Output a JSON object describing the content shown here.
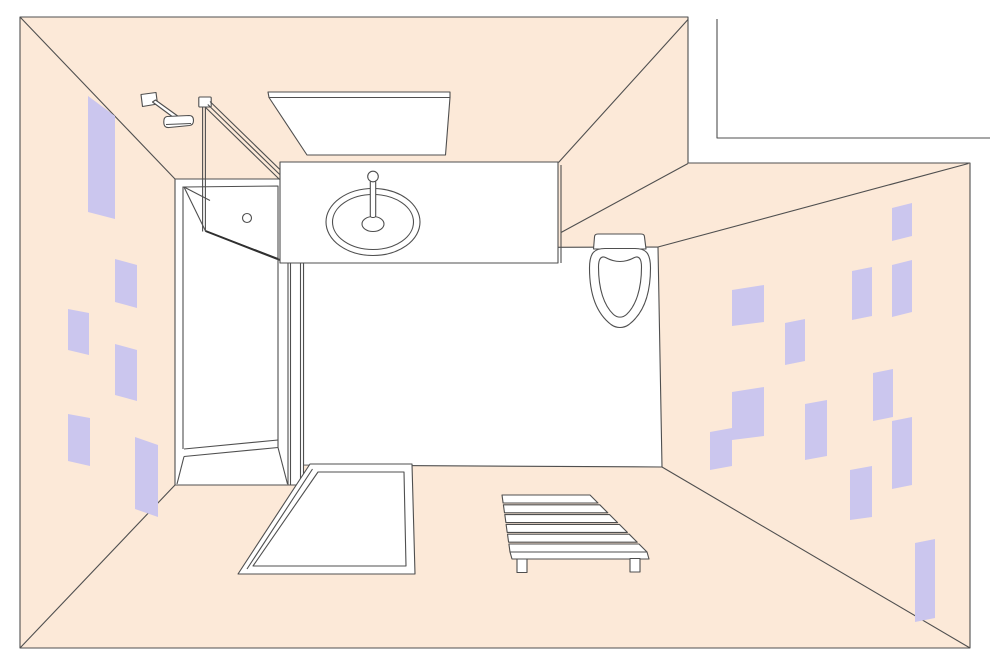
{
  "palette": {
    "wall": "#fce9d8",
    "tile": "#cbc6ee",
    "line": "#4f4f4f",
    "dark": "#2f2f2f",
    "white": "#ffffff",
    "none": "none"
  },
  "shapes": [
    {
      "name": "room-wall-band",
      "type": "polygon",
      "f": "wall",
      "s": "line",
      "attrs": {
        "points": "20,17 688,17 688,163 970,163 970,648 20,648"
      }
    },
    {
      "name": "adjacent-wall-line",
      "type": "polyline",
      "f": "none",
      "s": "line",
      "attrs": {
        "points": "717,19 717,138 990,138"
      }
    },
    {
      "name": "corner-seam-top-left",
      "type": "line",
      "f": "none",
      "s": "line",
      "attrs": {
        "x1": "20",
        "y1": "17",
        "x2": "175",
        "y2": "179"
      }
    },
    {
      "name": "corner-seam-bottom-left",
      "type": "line",
      "f": "none",
      "s": "line",
      "attrs": {
        "x1": "20",
        "y1": "648",
        "x2": "175",
        "y2": "485"
      }
    },
    {
      "name": "corner-seam-bottom-right",
      "type": "line",
      "f": "none",
      "s": "line",
      "attrs": {
        "x1": "970",
        "y1": "648",
        "x2": "662",
        "y2": "467"
      }
    },
    {
      "name": "corner-seam-top-right",
      "type": "line",
      "f": "none",
      "s": "line",
      "attrs": {
        "x1": "658",
        "y1": "247",
        "x2": "968.5",
        "y2": "163.5"
      }
    },
    {
      "name": "wall-corner-seam-upper",
      "type": "line",
      "f": "none",
      "s": "line",
      "attrs": {
        "x1": "561",
        "y1": "232.5",
        "x2": "688",
        "y2": "163.5"
      }
    },
    {
      "name": "wall-corner-seam-top",
      "type": "line",
      "f": "none",
      "s": "line",
      "attrs": {
        "x1": "558.5",
        "y1": "162.5",
        "x2": "688",
        "y2": "19.5"
      }
    },
    {
      "name": "left-wall-tile",
      "type": "polygon",
      "f": "tile",
      "s": "none",
      "attrs": {
        "points": "88,96 115,116 115,219 88,212"
      }
    },
    {
      "name": "left-wall-tile",
      "type": "polygon",
      "f": "tile",
      "s": "none",
      "attrs": {
        "points": "115,259 137,265 137,308 115,302"
      }
    },
    {
      "name": "left-wall-tile",
      "type": "polygon",
      "f": "tile",
      "s": "none",
      "attrs": {
        "points": "68,309 89,313 89,355 68,350"
      }
    },
    {
      "name": "left-wall-tile",
      "type": "polygon",
      "f": "tile",
      "s": "none",
      "attrs": {
        "points": "115,344 137,350 137,401 115,395"
      }
    },
    {
      "name": "left-wall-tile",
      "type": "polygon",
      "f": "tile",
      "s": "none",
      "attrs": {
        "points": "68,414 90,418 90,466 68,461"
      }
    },
    {
      "name": "left-wall-tile",
      "type": "polygon",
      "f": "tile",
      "s": "none",
      "attrs": {
        "points": "135,437 158,445 158,517 135,509"
      }
    },
    {
      "name": "right-wall-tile",
      "type": "polygon",
      "f": "tile",
      "s": "none",
      "attrs": {
        "points": "892,208 912,203 912,236 892,241"
      }
    },
    {
      "name": "right-wall-tile",
      "type": "polygon",
      "f": "tile",
      "s": "none",
      "attrs": {
        "points": "852,271 872,267 872,316 852,320"
      }
    },
    {
      "name": "right-wall-tile",
      "type": "polygon",
      "f": "tile",
      "s": "none",
      "attrs": {
        "points": "892,265 912,260 912,312 892,317"
      }
    },
    {
      "name": "right-wall-tile",
      "type": "polygon",
      "f": "tile",
      "s": "none",
      "attrs": {
        "points": "732,290 764,285 764,322 732,326"
      }
    },
    {
      "name": "right-wall-tile",
      "type": "polygon",
      "f": "tile",
      "s": "none",
      "attrs": {
        "points": "785,323 805,319 805,361 785,365"
      }
    },
    {
      "name": "right-wall-tile",
      "type": "polygon",
      "f": "tile",
      "s": "none",
      "attrs": {
        "points": "732,392 764,387 764,436 732,440"
      }
    },
    {
      "name": "right-wall-tile",
      "type": "polygon",
      "f": "tile",
      "s": "none",
      "attrs": {
        "points": "710,432 732,428 732,466 710,470"
      }
    },
    {
      "name": "right-wall-tile",
      "type": "polygon",
      "f": "tile",
      "s": "none",
      "attrs": {
        "points": "805,404 827,400 827,456 805,460"
      }
    },
    {
      "name": "right-wall-tile",
      "type": "polygon",
      "f": "tile",
      "s": "none",
      "attrs": {
        "points": "873,373 893,369 893,417 873,421"
      }
    },
    {
      "name": "right-wall-tile",
      "type": "polygon",
      "f": "tile",
      "s": "none",
      "attrs": {
        "points": "892,421 912,417 912,485 892,489"
      }
    },
    {
      "name": "right-wall-tile",
      "type": "polygon",
      "f": "tile",
      "s": "none",
      "attrs": {
        "points": "850,470 872,466 872,517 850,520"
      }
    },
    {
      "name": "right-wall-tile",
      "type": "polygon",
      "f": "tile",
      "s": "none",
      "attrs": {
        "points": "915,543 935,539 935,618 915,622"
      }
    },
    {
      "name": "floor",
      "type": "polygon",
      "f": "white",
      "s": "line",
      "attrs": {
        "points": "303.5,248 658,247 662,467 303.5,465"
      }
    },
    {
      "name": "ceiling-light-edge",
      "type": "polygon",
      "f": "white",
      "s": "line",
      "attrs": {
        "points": "268,92 450,92 450,97.5 269,97.5"
      }
    },
    {
      "name": "ceiling-light-panel",
      "type": "polygon",
      "f": "white",
      "s": "line",
      "attrs": {
        "points": "269,97.5 450,97.5 445.5,155 307,155"
      }
    },
    {
      "name": "towel-hook-plate",
      "type": "polygon",
      "f": "white",
      "s": "line",
      "attrs": {
        "points": "141,94.5 156,92.5 157.5,104 142.5,106.5"
      }
    },
    {
      "name": "towel-hook-arm",
      "type": "polygon",
      "f": "white",
      "s": "line",
      "attrs": {
        "points": "152.5,102 155.5,100 180.5,118 177.5,120.5"
      }
    },
    {
      "name": "towel-hook-bar",
      "type": "path",
      "f": "white",
      "s": "line",
      "attrs": {
        "d": "M167,116.5 L189,115.5 Q193.5,115.5 193.5,120.5 Q193.5,125 189.5,125.5 L169,127.5 Q164,128 163.8,122.5 Q163.6,117 167,116.5 Z"
      }
    },
    {
      "name": "towel-hook-bar-lip",
      "type": "line",
      "f": "none",
      "s": "line",
      "attrs": {
        "x1": "166",
        "y1": "124.5",
        "x2": "191",
        "y2": "123.5"
      }
    },
    {
      "name": "shower-enclosure",
      "type": "rect",
      "f": "white",
      "s": "line",
      "attrs": {
        "x": "175",
        "y": "179",
        "width": "128.5",
        "height": "306"
      }
    },
    {
      "name": "shower-inner-left-edge",
      "type": "line",
      "f": "none",
      "s": "line",
      "attrs": {
        "x1": "183",
        "y1": "186.5",
        "x2": "183",
        "y2": "449"
      }
    },
    {
      "name": "shower-door-panel",
      "type": "polygon",
      "f": "white",
      "s": "line",
      "attrs": {
        "points": "184,187 278,186 278,258.5 205.5,231"
      }
    },
    {
      "name": "shower-door-top-edge",
      "type": "line",
      "f": "none",
      "s": "line",
      "attrs": {
        "x1": "184",
        "y1": "187",
        "x2": "210",
        "y2": "200.5"
      }
    },
    {
      "name": "shower-door-front-edge",
      "type": "line",
      "f": "none",
      "s": "dark",
      "w": 2,
      "attrs": {
        "x1": "205.5",
        "y1": "231",
        "x2": "280",
        "y2": "260"
      }
    },
    {
      "name": "shower-door-handle",
      "type": "circle",
      "f": "white",
      "s": "line",
      "attrs": {
        "cx": "247",
        "cy": "218",
        "r": "4.5"
      }
    },
    {
      "name": "shower-tray-right-edge",
      "type": "line",
      "f": "none",
      "s": "line",
      "attrs": {
        "x1": "278",
        "y1": "258.5",
        "x2": "278",
        "y2": "447.5"
      }
    },
    {
      "name": "shower-tray-bottom-edge",
      "type": "line",
      "f": "none",
      "s": "line",
      "attrs": {
        "x1": "184",
        "y1": "449",
        "x2": "278",
        "y2": "440"
      }
    },
    {
      "name": "shower-tray-bottom-rim",
      "type": "line",
      "f": "none",
      "s": "line",
      "attrs": {
        "x1": "184",
        "y1": "456.5",
        "x2": "278",
        "y2": "447.5"
      }
    },
    {
      "name": "shower-tray-corner-left",
      "type": "line",
      "f": "none",
      "s": "line",
      "attrs": {
        "x1": "184",
        "y1": "456.5",
        "x2": "177",
        "y2": "484"
      }
    },
    {
      "name": "shower-tray-corner-right",
      "type": "line",
      "f": "none",
      "s": "line",
      "attrs": {
        "x1": "278",
        "y1": "447.5",
        "x2": "287.5",
        "y2": "484"
      }
    },
    {
      "name": "shower-frame-rail-a",
      "type": "line",
      "f": "none",
      "s": "line",
      "attrs": {
        "x1": "288",
        "y1": "263",
        "x2": "288",
        "y2": "484.5"
      }
    },
    {
      "name": "shower-frame-rail-b",
      "type": "line",
      "f": "none",
      "s": "line",
      "attrs": {
        "x1": "290.5",
        "y1": "263",
        "x2": "290.5",
        "y2": "484.5"
      }
    },
    {
      "name": "shower-frame-rail-c",
      "type": "line",
      "f": "none",
      "s": "line",
      "attrs": {
        "x1": "300.5",
        "y1": "263",
        "x2": "300.5",
        "y2": "484.5"
      }
    },
    {
      "name": "shower-pole-cap",
      "type": "rect",
      "f": "white",
      "s": "line",
      "attrs": {
        "x": "198.8",
        "y": "97",
        "width": "12.4",
        "height": "10",
        "rx": "1"
      }
    },
    {
      "name": "shower-pole-left",
      "type": "line",
      "f": "none",
      "s": "line",
      "attrs": {
        "x1": "202.6",
        "y1": "107",
        "x2": "202.6",
        "y2": "231.5"
      }
    },
    {
      "name": "shower-pole-right",
      "type": "line",
      "f": "none",
      "s": "line",
      "attrs": {
        "x1": "205.4",
        "y1": "107",
        "x2": "205.4",
        "y2": "231.5"
      }
    },
    {
      "name": "shower-door-rail-1",
      "type": "line",
      "f": "none",
      "s": "line",
      "attrs": {
        "x1": "210",
        "y1": "101.5",
        "x2": "284",
        "y2": "173.5"
      }
    },
    {
      "name": "shower-door-rail-2",
      "type": "line",
      "f": "none",
      "s": "line",
      "attrs": {
        "x1": "207.8",
        "y1": "104.5",
        "x2": "281.8",
        "y2": "176.5"
      }
    },
    {
      "name": "shower-door-rail-3",
      "type": "line",
      "f": "none",
      "s": "line",
      "attrs": {
        "x1": "205.6",
        "y1": "107.5",
        "x2": "279.6",
        "y2": "179.5"
      }
    },
    {
      "name": "sink-counter",
      "type": "rect",
      "f": "white",
      "s": "line",
      "attrs": {
        "x": "280",
        "y": "162",
        "width": "278",
        "height": "101"
      }
    },
    {
      "name": "sink-counter-side-edge",
      "type": "line",
      "f": "none",
      "s": "line",
      "attrs": {
        "x1": "561",
        "y1": "165",
        "x2": "561",
        "y2": "263"
      }
    },
    {
      "name": "sink-basin-outer",
      "type": "ellipse",
      "f": "white",
      "s": "line",
      "attrs": {
        "cx": "373",
        "cy": "222",
        "rx": "47",
        "ry": "33.5"
      }
    },
    {
      "name": "sink-basin-inner",
      "type": "ellipse",
      "f": "none",
      "s": "line",
      "attrs": {
        "cx": "373",
        "cy": "222",
        "rx": "40.5",
        "ry": "27.5"
      }
    },
    {
      "name": "sink-drain",
      "type": "ellipse",
      "f": "none",
      "s": "line",
      "attrs": {
        "cx": "373",
        "cy": "224",
        "rx": "11",
        "ry": "7.5"
      }
    },
    {
      "name": "sink-faucet-stem",
      "type": "rect",
      "f": "white",
      "s": "line",
      "attrs": {
        "x": "370.3",
        "y": "180",
        "width": "5.4",
        "height": "37.5",
        "rx": "2"
      }
    },
    {
      "name": "sink-faucet-knob",
      "type": "circle",
      "f": "white",
      "s": "line",
      "attrs": {
        "cx": "373",
        "cy": "176.5",
        "r": "5.3"
      }
    },
    {
      "name": "toilet-tank",
      "type": "path",
      "f": "white",
      "s": "line",
      "attrs": {
        "d": "M593.5,249 L594.5,237 Q594.5,234 598,234 L641,234 Q644.5,234 644.5,237 L646,249 Z"
      }
    },
    {
      "name": "toilet-bowl",
      "type": "path",
      "f": "white",
      "s": "line",
      "attrs": {
        "d": "M589.5,268 C589.5,252 595,248.5 605,248.5 L635,248.5 C645,248.5 650.5,252 650.5,268 C650.5,294 644,313 629,324.5 C623.5,328.5 616.5,328.5 611,324.5 C596,313 589.5,294 589.5,268 Z"
      }
    },
    {
      "name": "toilet-seat",
      "type": "path",
      "f": "none",
      "s": "line",
      "attrs": {
        "d": "M598.5,267 C598.5,259 601,255.5 605.5,257.5 C611,260.5 615,261.5 620,261.5 C625,261.5 629,260.5 634.5,257.5 C639,255.5 641.5,259 641.5,267 C641.5,289 636,305.5 626.5,314.5 C622.5,318 617.5,318 613.5,314.5 C604,305.5 598.5,289 598.5,267 Z"
      }
    },
    {
      "name": "bath-mat-outer",
      "type": "polygon",
      "f": "white",
      "s": "line",
      "attrs": {
        "points": "310,464 412,464 415,574 238,574"
      }
    },
    {
      "name": "bath-mat-hem-line",
      "type": "line",
      "f": "none",
      "s": "line",
      "attrs": {
        "x1": "312.5",
        "y1": "469",
        "x2": "247",
        "y2": "569"
      }
    },
    {
      "name": "bath-mat-inner",
      "type": "polygon",
      "f": "none",
      "s": "line",
      "attrs": {
        "points": "318,472 404,472 406,566 253,566"
      }
    },
    {
      "name": "bench-slat",
      "type": "polygon",
      "f": "white",
      "s": "line",
      "attrs": {
        "points": "502,495 590,495 598,503 503.1,503"
      }
    },
    {
      "name": "bench-slat",
      "type": "polygon",
      "f": "white",
      "s": "line",
      "attrs": {
        "points": "503.4,504.8 599.8,504.8 607.8,512.8 504.5,512.8"
      }
    },
    {
      "name": "bench-slat",
      "type": "polygon",
      "f": "white",
      "s": "line",
      "attrs": {
        "points": "504.8,514.6 609.6,514.6 617.6,522.6 505.9,522.6"
      }
    },
    {
      "name": "bench-slat",
      "type": "polygon",
      "f": "white",
      "s": "line",
      "attrs": {
        "points": "506.1,524.4 619.4,524.4 627.4,532.4 507.2,532.4"
      }
    },
    {
      "name": "bench-slat",
      "type": "polygon",
      "f": "white",
      "s": "line",
      "attrs": {
        "points": "507.5,534.2 629.2,534.2 637.2,542.2 508.6,542.2"
      }
    },
    {
      "name": "bench-slat",
      "type": "polygon",
      "f": "white",
      "s": "line",
      "attrs": {
        "points": "508.9,544 639,544 647,552 510,552"
      }
    },
    {
      "name": "bench-front-face",
      "type": "polygon",
      "f": "white",
      "s": "line",
      "attrs": {
        "points": "510,552 647,552 649,559 512,559"
      }
    },
    {
      "name": "bench-leg-left",
      "type": "rect",
      "f": "white",
      "s": "line",
      "attrs": {
        "x": "517",
        "y": "559",
        "width": "10",
        "height": "13.5"
      }
    },
    {
      "name": "bench-leg-right",
      "type": "rect",
      "f": "white",
      "s": "line",
      "attrs": {
        "x": "630",
        "y": "558.5",
        "width": "10",
        "height": "13.5"
      }
    }
  ]
}
